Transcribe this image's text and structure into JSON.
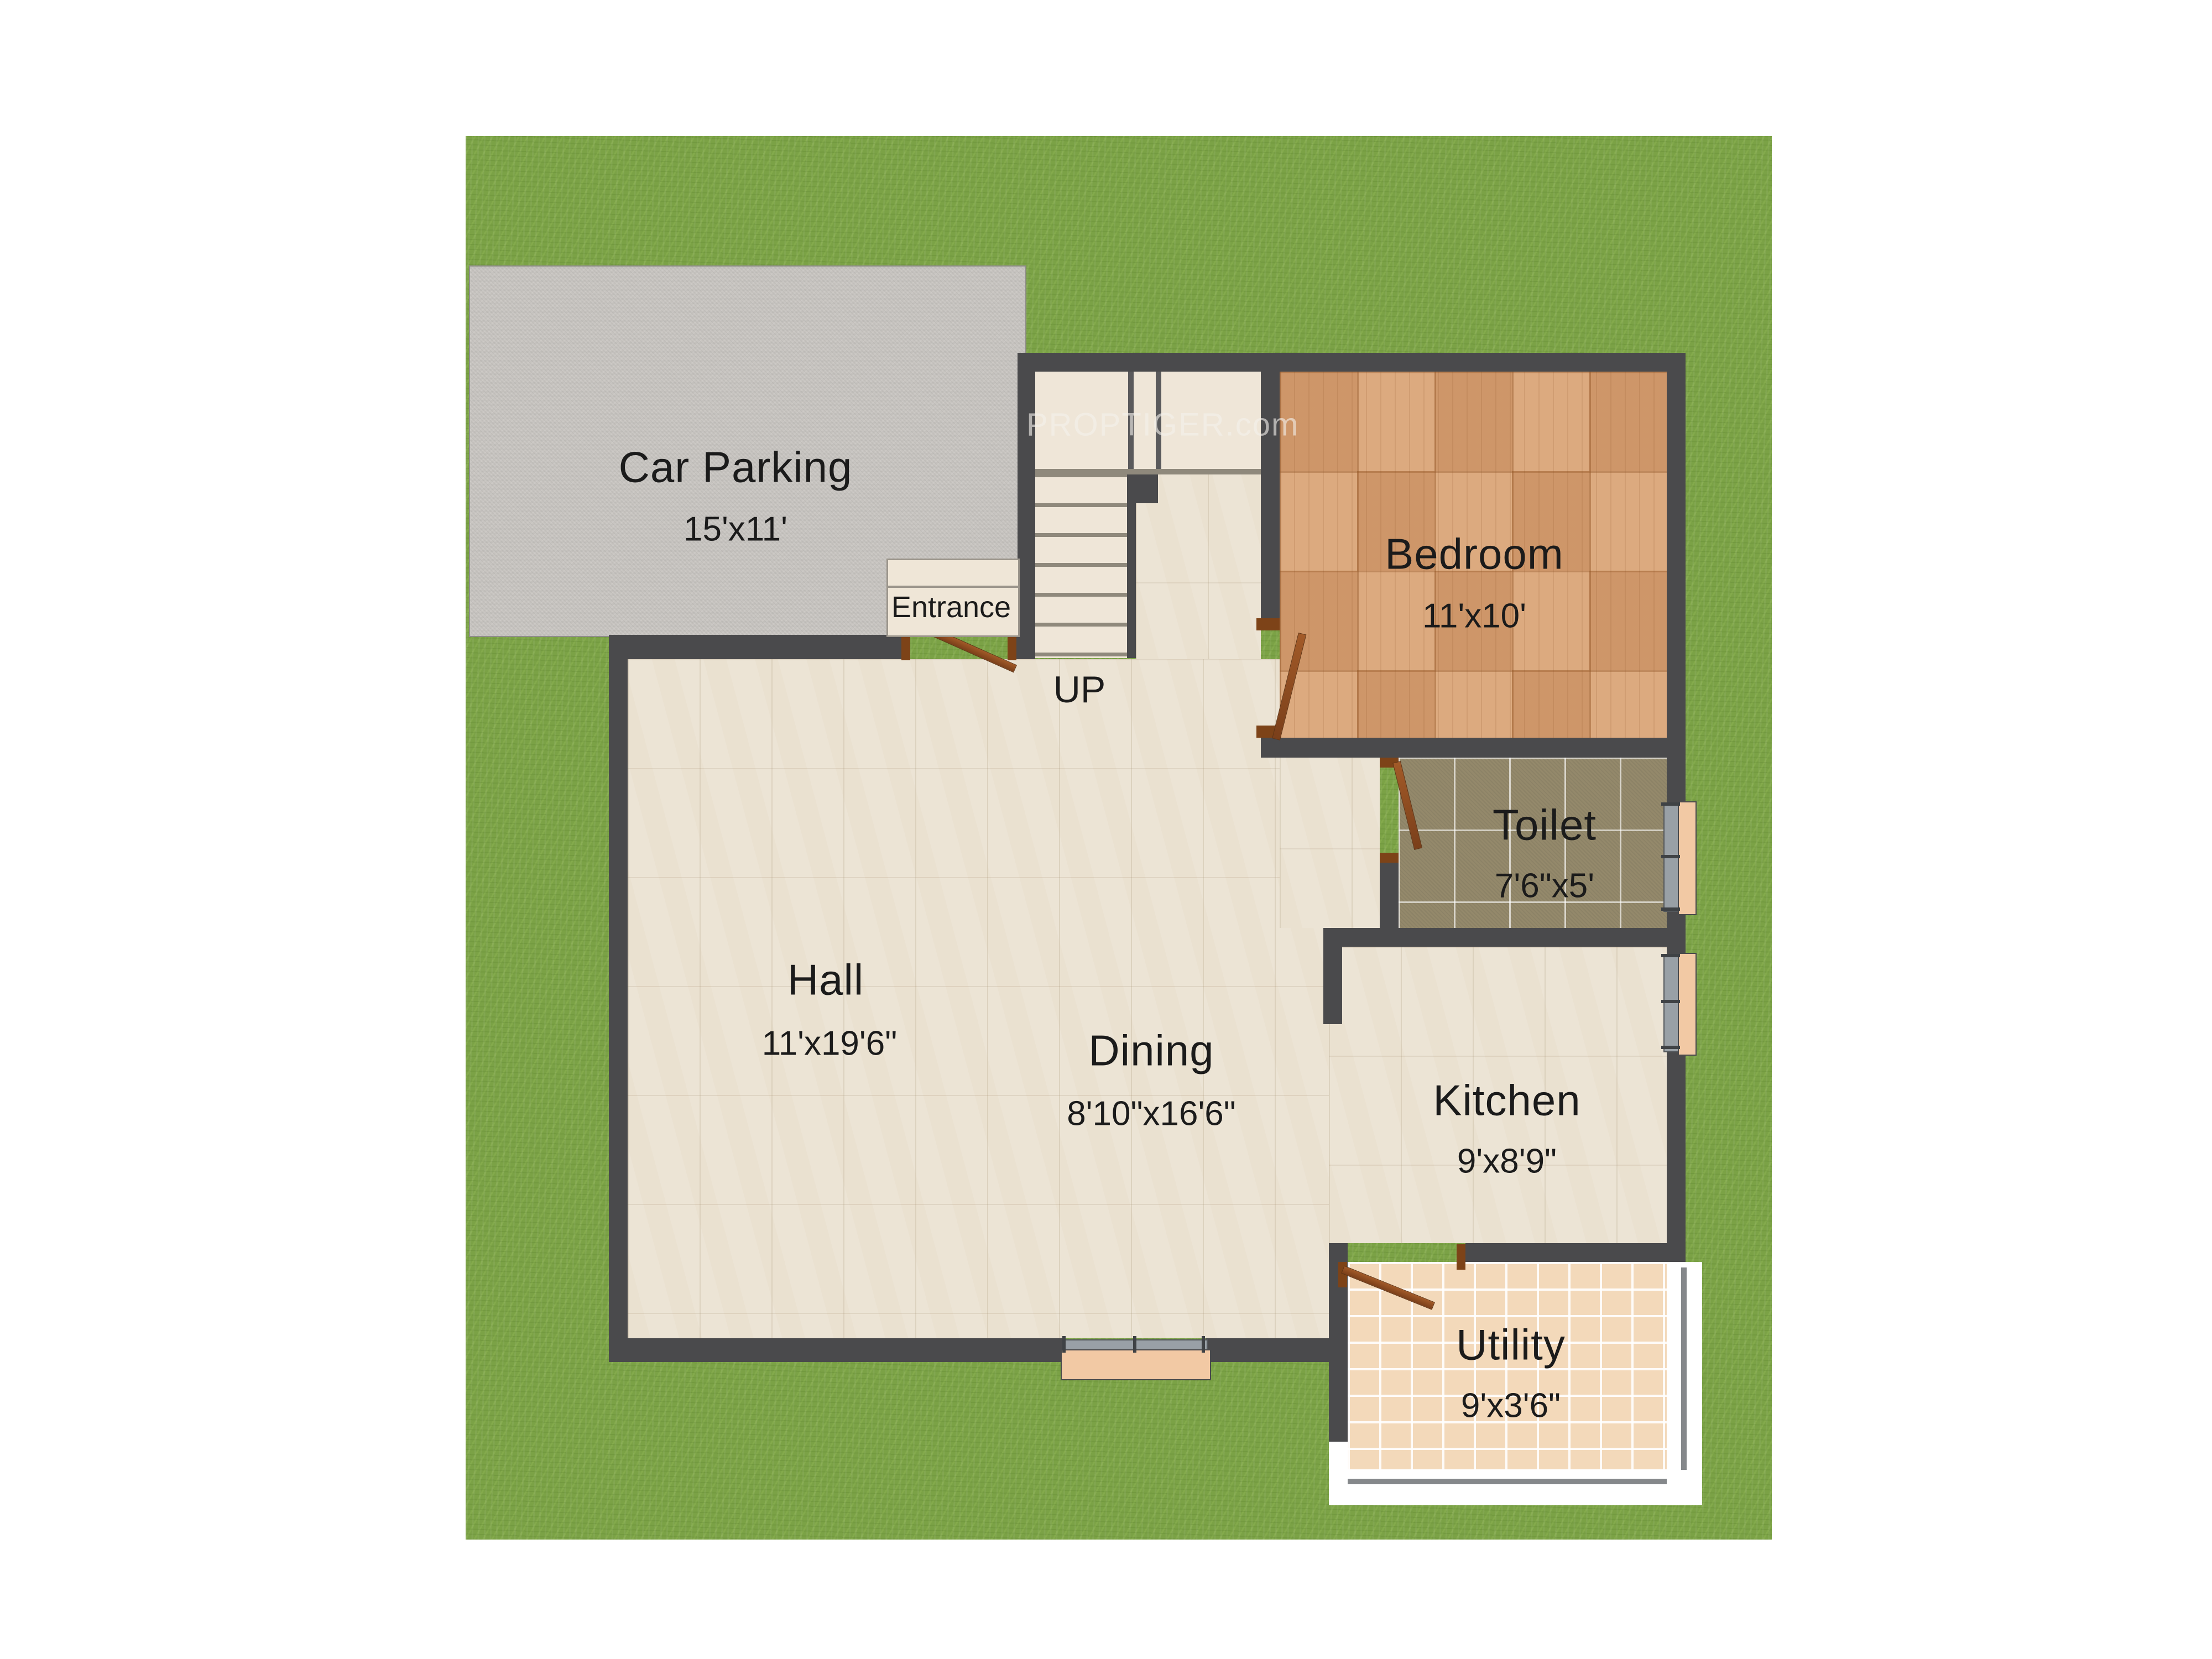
{
  "watermark": "PROPTIGER.com",
  "rooms": {
    "car_parking": {
      "name": "Car Parking",
      "dims": "15'x11'"
    },
    "hall": {
      "name": "Hall",
      "dims": "11'x19'6\""
    },
    "dining": {
      "name": "Dining",
      "dims": "8'10\"x16'6\""
    },
    "bedroom": {
      "name": "Bedroom",
      "dims": "11'x10'"
    },
    "toilet": {
      "name": "Toilet",
      "dims": "7'6\"x5'"
    },
    "kitchen": {
      "name": "Kitchen",
      "dims": "9'x8'9\""
    },
    "utility": {
      "name": "Utility",
      "dims": "9'x3'6\""
    }
  },
  "annotations": {
    "entrance": "Entrance",
    "up": "UP"
  },
  "colors": {
    "wall": "#4a4a4c",
    "grass": "#7ba246",
    "floor_marble": "#ece4d5",
    "floor_wood": "#d8a071",
    "floor_toilet": "#94896b",
    "floor_utility": "#f3d9ba",
    "parking": "#c8c5c1",
    "stairs": "#efe6d8",
    "door": "#8a4a21",
    "window_pane": "#f2c9a4",
    "window_sill": "#99a0a6",
    "label_text": "#1b1b1b"
  }
}
